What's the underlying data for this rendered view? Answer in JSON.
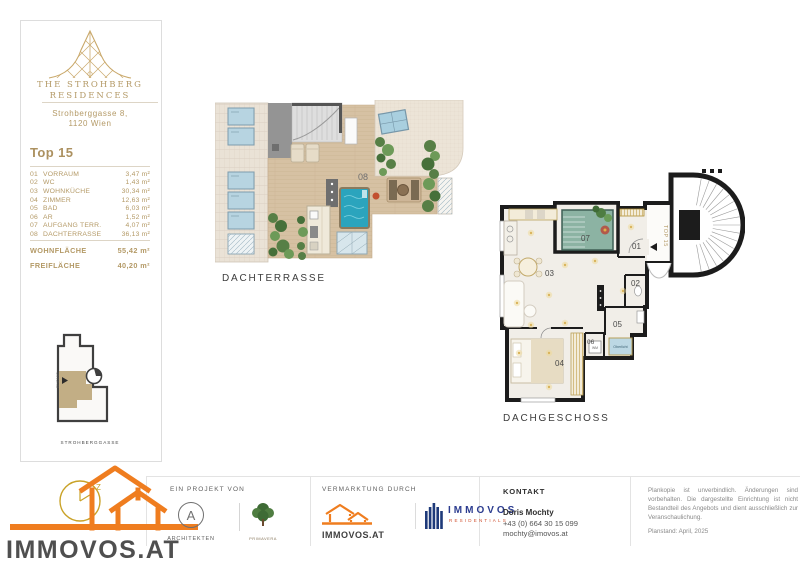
{
  "colors": {
    "gold": "#b49a67",
    "orange": "#ef7d1f",
    "navy": "#2b3c8f",
    "red": "#d14f2e"
  },
  "sidebar": {
    "brand_line1": "THE STROHBERG",
    "brand_line2": "RESIDENCES",
    "address_line1": "Strohberggasse 8,",
    "address_line2": "1120 Wien",
    "unit_title": "Top 15",
    "rooms": [
      {
        "no": "01",
        "name": "VORRAUM",
        "area": "3,47 m²"
      },
      {
        "no": "02",
        "name": "WC",
        "area": "1,43 m²"
      },
      {
        "no": "03",
        "name": "WOHNKÜCHE",
        "area": "30,34 m²"
      },
      {
        "no": "04",
        "name": "ZIMMER",
        "area": "12,63 m²"
      },
      {
        "no": "05",
        "name": "BAD",
        "area": "6,03 m²"
      },
      {
        "no": "06",
        "name": "AR",
        "area": "1,52 m²"
      },
      {
        "no": "07",
        "name": "AUFGANG TERR.",
        "area": "4,07 m²"
      },
      {
        "no": "08",
        "name": "DACHTERRASSE",
        "area": "36,13 m²"
      }
    ],
    "total_living_label": "WOHNFLÄCHE",
    "total_living_value": "55,42 m²",
    "total_outdoor_label": "FREIFLÄCHE",
    "total_outdoor_value": "40,20 m²",
    "site_plan": {
      "street": "STROHBERGGASSE",
      "entrance": "EINGANG"
    }
  },
  "plans": {
    "terrace": {
      "label": "DACHTERRASSE",
      "room_no": "08"
    },
    "floor": {
      "label": "DACHGESCHOSS",
      "unit": "TOP 15",
      "rooms": [
        "01",
        "02",
        "03",
        "04",
        "05",
        "06",
        "07"
      ],
      "skylight": "Oberlicht",
      "washer": "WM"
    }
  },
  "footer": {
    "project_label": "EIN PROJEKT VON",
    "architects": "ARCHITEKTEN",
    "partner": "PRIMAVERA",
    "marketing_label": "VERMARKTUNG DURCH",
    "immovos_small": "IMMOVOS.AT",
    "residentials_name": "IMMOVOS",
    "residentials_sub": "RESIDENTIALS",
    "contact_label": "KONTAKT",
    "contact_name": "Doris Mochty",
    "contact_phone": "+43 (0) 664 30 15 099",
    "contact_email": "mochty@imovos.at",
    "disclaimer": "Plankopie ist unverbindlich. Änderungen sind vorbehalten. Die dargestellte Einrichtung ist nicht Bestandteil des Angebots und dient ausschließlich zur Veranschaulichung.",
    "plan_date": "Planstand: April, 2025",
    "logo_text": "IMMOVOS.AT"
  }
}
